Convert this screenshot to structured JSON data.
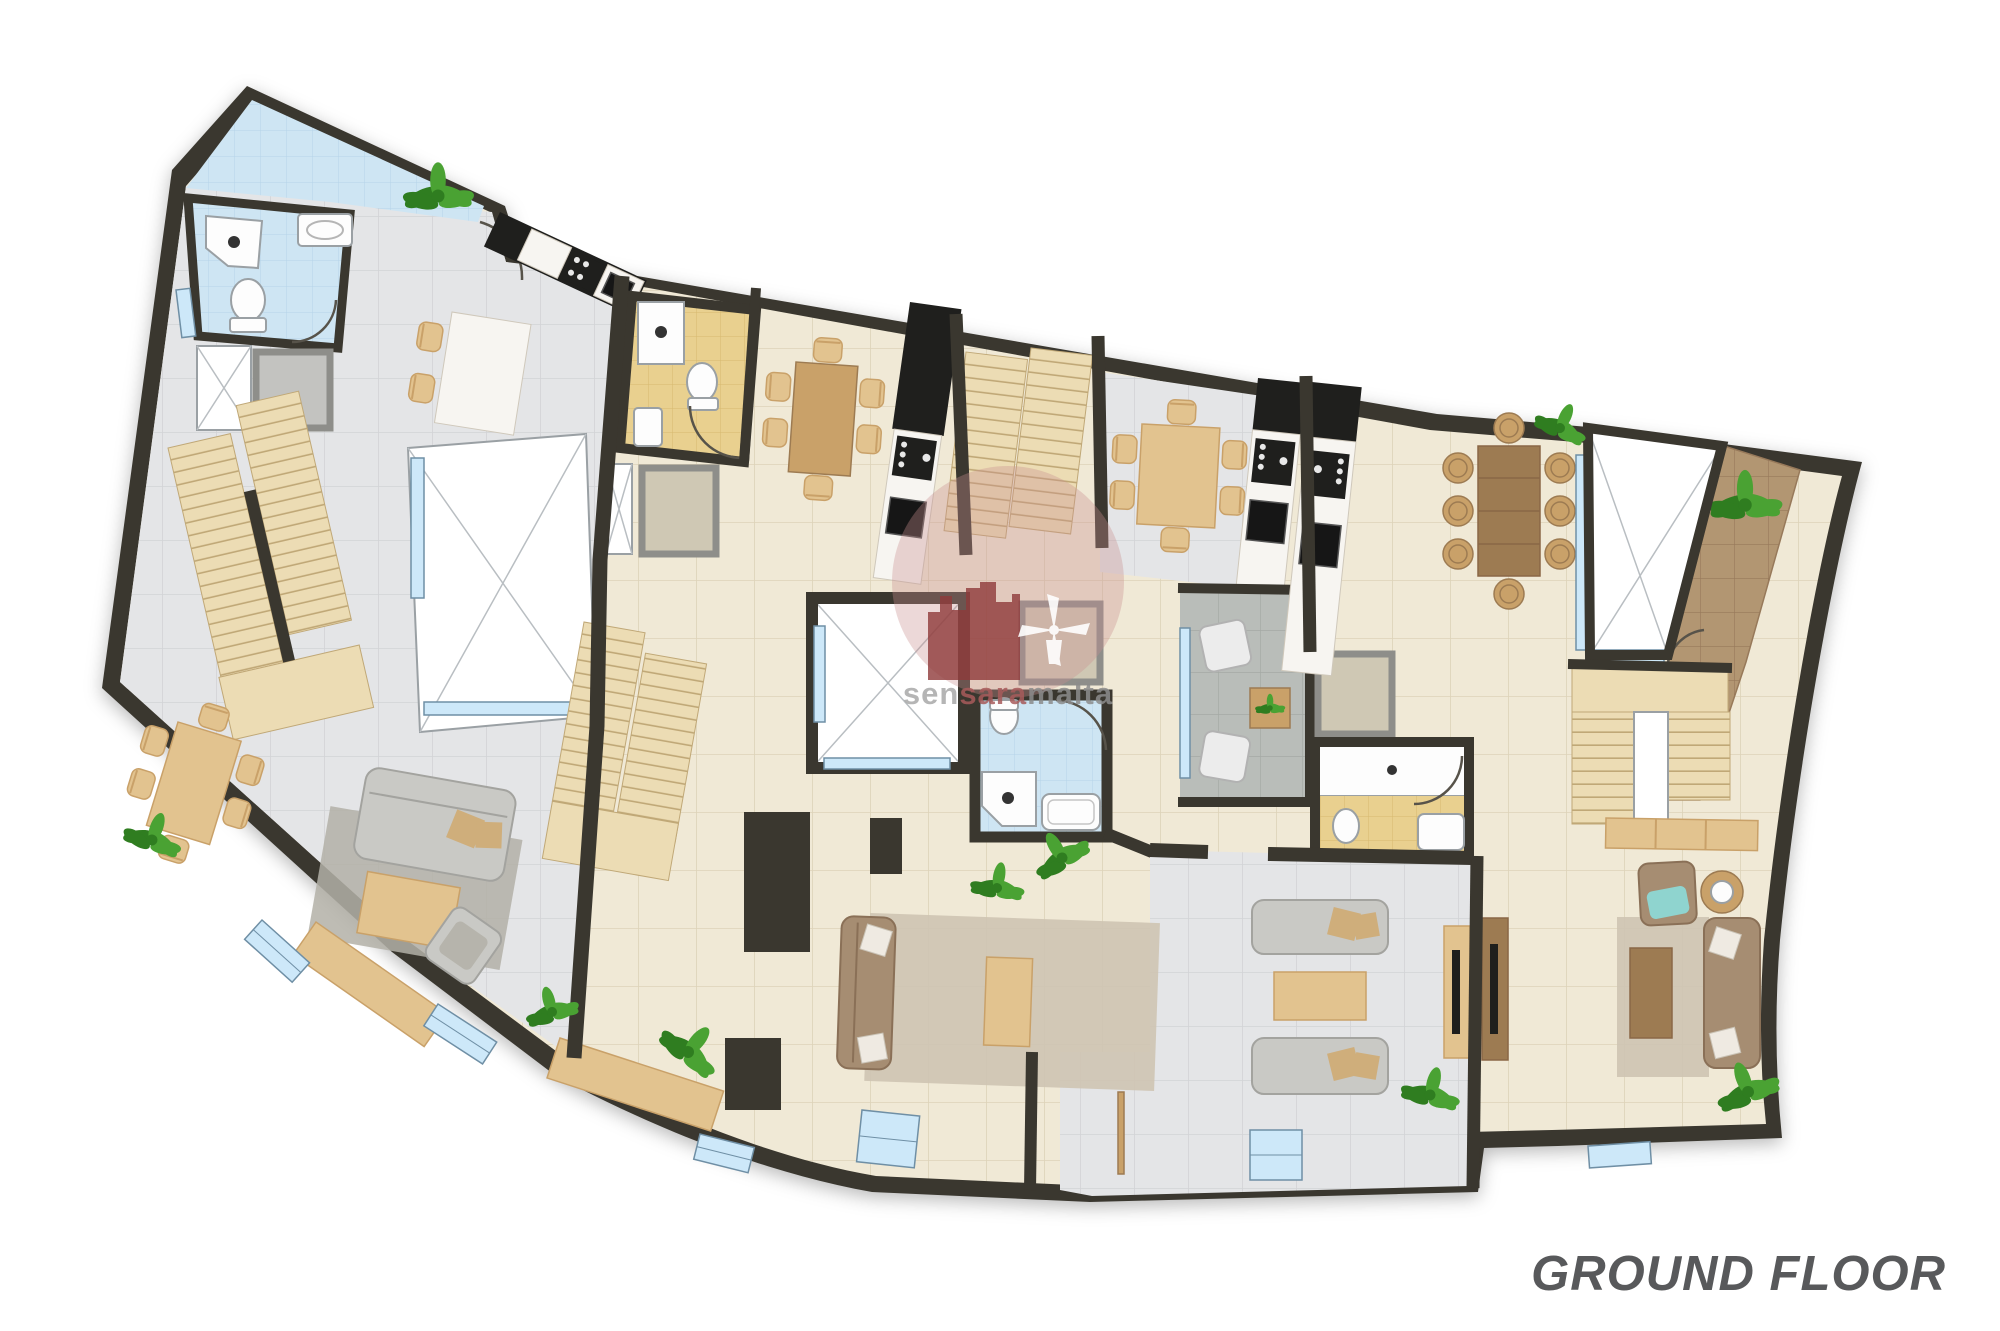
{
  "title": {
    "text": "GROUND FLOOR"
  },
  "watermark": {
    "sen": "sen",
    "sara": "sara",
    "malta": "malta"
  },
  "palette": {
    "bg": "#ffffff",
    "wall": "#3a372f",
    "floor_cream": "#f0e9d6",
    "tile_line_cream": "#ddd3b8",
    "floor_gray": "#e4e5e7",
    "tile_line_gray": "#d2d3d6",
    "bath_blue": "#cee5f3",
    "tile_line_blue": "#b5d4e8",
    "bath_yellow": "#e9d08f",
    "tile_line_yellow": "#d6b96f",
    "window_blue": "#cde8f9",
    "window_frame": "#6f8fa5",
    "stair": "#ecdcb4",
    "stair_line": "#c0a877",
    "shaft_line": "#9aa0a4",
    "terrace_gray": "#b9bdb9",
    "terrace_line": "#a5aaa5",
    "path_brown": "#b29672",
    "path_line": "#97795a",
    "marble": "#f7f5f1",
    "marble_line": "#cfc8bb",
    "counter_black": "#1f1f1d",
    "lift": "#cfc8b4",
    "lift_frame": "#8e8e8a",
    "wood_light": "#e2c38f",
    "wood_mid": "#c9a169",
    "wood_dark": "#9d7b52",
    "wood_brown": "#8a6746",
    "sofa_gray": "#c9c9c5",
    "sofa_gray_dark": "#a3a39f",
    "sofa_brown": "#a68d72",
    "sofa_brown_dark": "#8a7057",
    "cushion": "#cfae7b",
    "rug_gray": "#b3b0a7",
    "rug_beige": "#cec4b2",
    "plant": "#4aa233",
    "plant_dark": "#2f7d20",
    "fixture": "#fdfdfd",
    "fixture_stroke": "#9aa0a4",
    "door": "#57534a",
    "teal": "#8fd4cf",
    "wm_circle": "#c98f8f",
    "wm_emblem": "#8e3a3a",
    "wm_text1": "#a9a9a9",
    "wm_text2": "#a85b5b",
    "wm_text3": "#8c8c8c",
    "title_color": "#58595b"
  }
}
